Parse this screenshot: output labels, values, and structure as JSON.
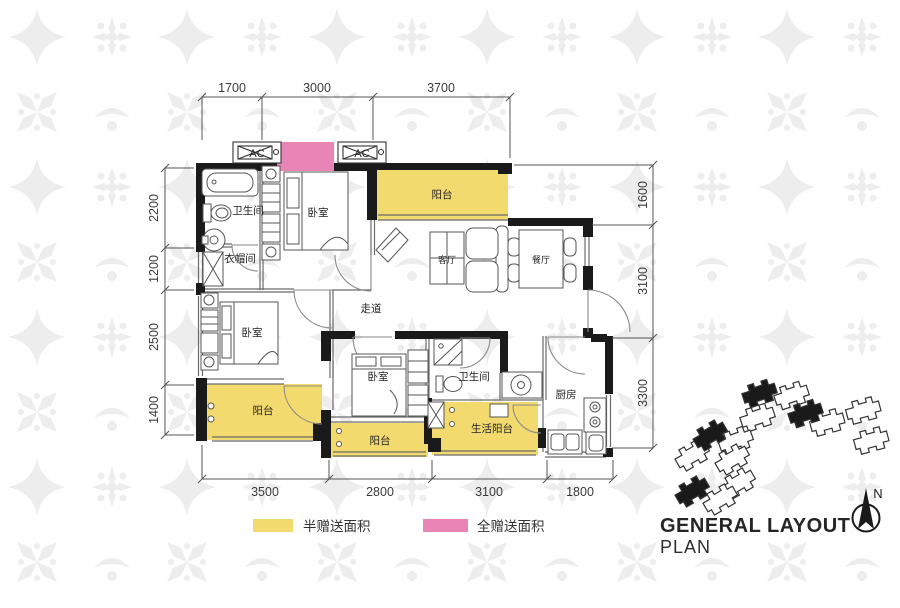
{
  "plan": {
    "rooms": {
      "bathroom": "卫生间",
      "bedroom": "卧室",
      "cloakroom": "衣帽间",
      "corridor": "走道",
      "living": "客厅",
      "dining": "餐厅",
      "balcony": "阳台",
      "life_balcony": "生活阳台",
      "kitchen": "厨房",
      "ac": "AC"
    },
    "dims": {
      "top": [
        "1700",
        "3000",
        "3700"
      ],
      "left": [
        "2200",
        "1200",
        "2500",
        "1400"
      ],
      "right": [
        "1600",
        "3100",
        "3300"
      ],
      "bottom": [
        "3500",
        "2800",
        "3100",
        "1800"
      ]
    },
    "colors": {
      "half_gift": "#f3da6e",
      "full_gift": "#e884b6",
      "wall": "#1a1a1a"
    }
  },
  "legend": {
    "items": [
      {
        "label": "半赠送面积",
        "color": "#f3da6e"
      },
      {
        "label": "全赠送面积",
        "color": "#e884b6"
      }
    ]
  },
  "footer": {
    "title": "GENERAL LAYOUT",
    "subtitle": "PLAN"
  },
  "compass": {
    "north": "N"
  }
}
